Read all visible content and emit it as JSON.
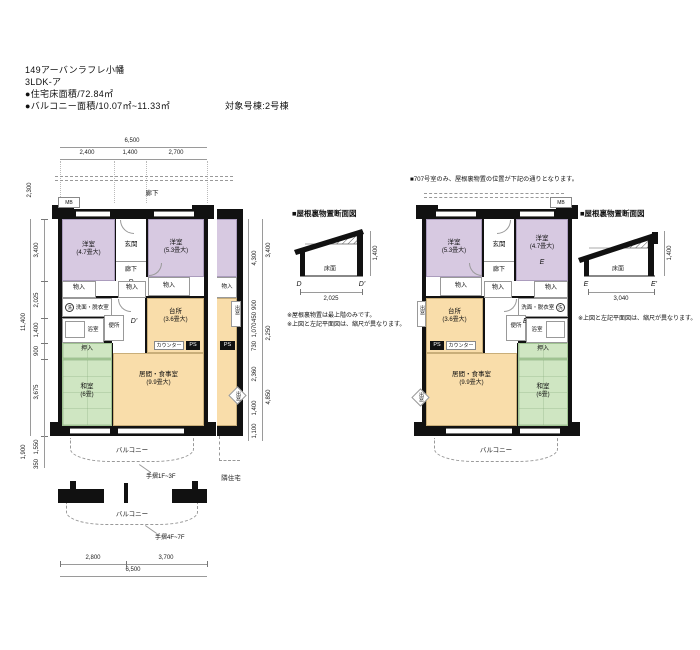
{
  "header": {
    "title": "149アーバンラフレ小幡",
    "plan_type": "3LDK-ア",
    "area_line": "●住宅床面積/72.84㎡",
    "balcony_line": "●バルコニー面積/10.07㎡~11.33㎡",
    "target_building": "対象号棟:2号棟"
  },
  "colors": {
    "western_room": "#d7c9e1",
    "living_dining": "#f9ddaa",
    "tatami_room": "#cfe6c2",
    "wall": "#111111"
  },
  "plan_left": {
    "corridor_label": "廊下",
    "mb_label": "MB",
    "dims_top": {
      "total": "6,500",
      "seg1": "2,400",
      "seg2": "1,400",
      "seg3": "2,700"
    },
    "dims_left": {
      "offset": "2,300",
      "total": "11,400",
      "seg1": "3,400",
      "seg2": "2,025",
      "seg3": "1,400",
      "seg4": "900",
      "seg5": "3,675",
      "lower_total": "1,900",
      "lower1": "1,550",
      "lower2": "350"
    },
    "dims_right": {
      "in1": "4,300",
      "in2": "900",
      "in3": "450",
      "in4": "1,070",
      "in5": "730",
      "in6": "2,360",
      "in7": "1,400",
      "in8": "1,100",
      "out1": "3,400",
      "out2": "2,250",
      "out3": "4,850"
    },
    "dims_bottom": {
      "seg1": "2,800",
      "seg2": "3,700",
      "total": "6,500"
    },
    "rooms": {
      "west1_name": "洋室",
      "west1_size": "(4.7畳大)",
      "west2_name": "洋室",
      "west2_size": "(5.3畳大)",
      "entrance": "玄関",
      "hall": "廊下",
      "marker_d": "D",
      "marker_d_prime": "D'",
      "closet": "物入",
      "washroom": "洗面・脱衣室",
      "laundry": "洗",
      "toilet": "便所",
      "bath": "浴室",
      "kitchen_name": "台所",
      "kitchen_size": "(3.6畳大)",
      "counter": "カウンター",
      "ps": "PS",
      "living_name": "居間・食事室",
      "living_size": "(9.9畳大)",
      "oshiire": "押入",
      "tatami_name": "和室",
      "tatami_size": "(6畳)",
      "bay_window": "出窓"
    },
    "balcony_label": "バルコニー",
    "handrail_low": "手摺1F~3F",
    "handrail_high": "手摺4F~7F",
    "neighbor_label": "隣住宅"
  },
  "plan_right": {
    "note": "■707号室のみ、屋根裏物置の位置が下記の通りとなります。",
    "mb_label": "MB",
    "rooms": {
      "west1_name": "洋室",
      "west1_size": "(5.3畳大)",
      "west2_name": "洋室",
      "west2_size": "(4.7畳大)",
      "entrance": "玄関",
      "hall": "廊下",
      "marker_e": "E",
      "marker_e_prime": "E'",
      "closet": "物入",
      "washroom": "洗面・脱衣室",
      "laundry": "洗",
      "toilet": "便所",
      "bath": "浴室",
      "kitchen_name": "台所",
      "kitchen_size": "(3.6畳大)",
      "counter": "カウンター",
      "ps": "PS",
      "living_name": "居間・食事室",
      "living_size": "(9.9畳大)",
      "oshiire": "押入",
      "tatami_name": "和室",
      "tatami_size": "(6畳)",
      "bay_window": "出窓"
    },
    "balcony_label": "バルコニー"
  },
  "section_d": {
    "title": "■屋根裏物置断面図",
    "floor_label": "床面",
    "height_dim": "1,400",
    "width_dim": "2,025",
    "marker_left": "D",
    "marker_right": "D'",
    "note1": "※屋根裏物置は最上階のみです。",
    "note2": "※上図と左記平面図は、縮尺が異なります。"
  },
  "section_e": {
    "title": "■屋根裏物置断面図",
    "floor_label": "床面",
    "height_dim": "1,400",
    "width_dim": "3,040",
    "marker_left": "E",
    "marker_right": "E'",
    "note": "※上図と左記平面図は、縮尺が異なります。"
  }
}
